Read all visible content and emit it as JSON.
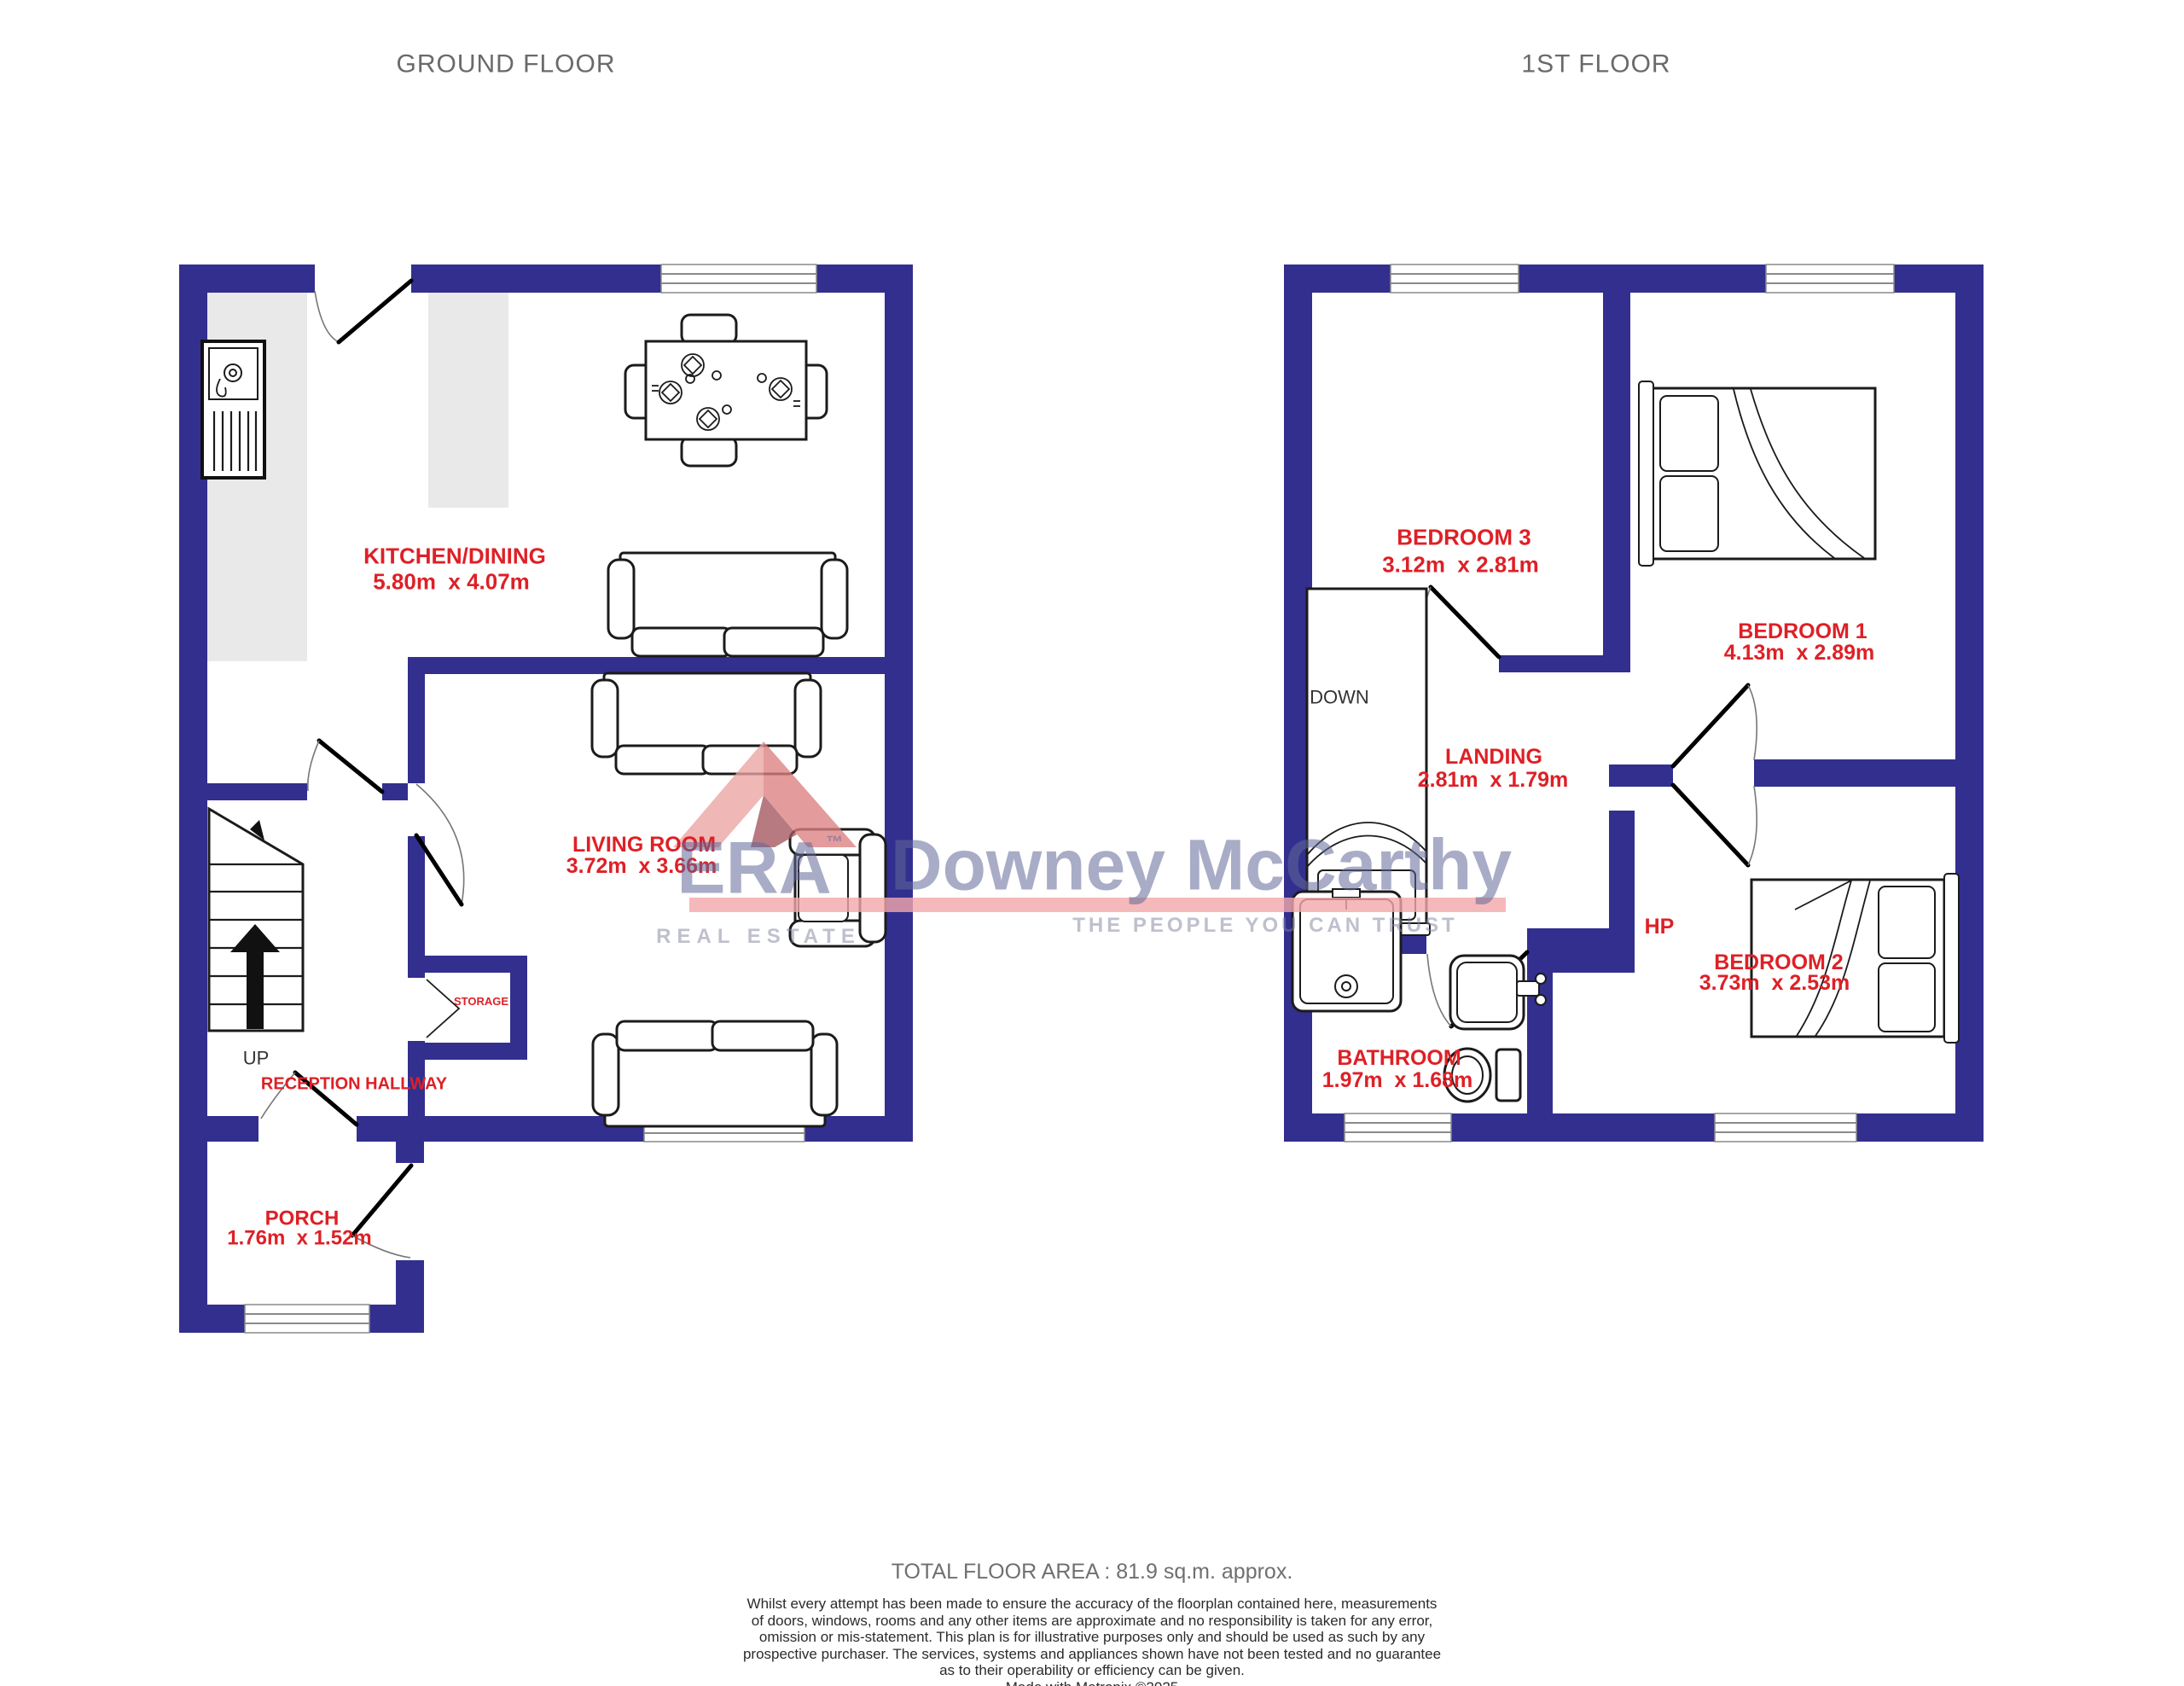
{
  "titles": {
    "ground": "GROUND FLOOR",
    "first": "1ST FLOOR"
  },
  "ground_floor": {
    "kitchen_dining": {
      "name": "KITCHEN/DINING",
      "dims": "5.80m  x 4.07m"
    },
    "living_room": {
      "name": "LIVING ROOM",
      "dims": "3.72m  x 3.66m"
    },
    "reception_hallway": {
      "name": "RECEPTION HALLWAY"
    },
    "storage": {
      "name": "STORAGE"
    },
    "porch": {
      "name": "PORCH",
      "dims": "1.76m  x 1.52m"
    },
    "stairs_label": "UP"
  },
  "first_floor": {
    "bedroom1": {
      "name": "BEDROOM 1",
      "dims": "4.13m  x 2.89m"
    },
    "bedroom2": {
      "name": "BEDROOM 2",
      "dims": "3.73m  x 2.53m"
    },
    "bedroom3": {
      "name": "BEDROOM 3",
      "dims": "3.12m  x 2.81m"
    },
    "landing": {
      "name": "LANDING",
      "dims": "2.81m  x 1.79m"
    },
    "bathroom": {
      "name": "BATHROOM",
      "dims": "1.97m  x 1.68m"
    },
    "hot_press": {
      "name": "HP"
    },
    "stairs_label": "DOWN"
  },
  "watermark": {
    "brand": "ERA",
    "tm": "™",
    "name": "Downey McCarthy",
    "tagline_left": "REAL ESTATE",
    "tagline_right": "THE PEOPLE YOU CAN TRUST"
  },
  "footer": {
    "total_area": "TOTAL FLOOR AREA : 81.9 sq.m. approx.",
    "disclaimer_lines": [
      "Whilst every attempt has been made to ensure the accuracy of the floorplan contained here, measurements",
      "of doors, windows, rooms and any other items are approximate and no responsibility is taken for any error,",
      "omission or mis-statement. This plan is for illustrative purposes only and should be used as such by any",
      "prospective purchaser. The services, systems and appliances shown have not been tested and no guarantee",
      "as to their operability or efficiency can be given."
    ],
    "credit": "Made with Metropix ©2025"
  },
  "colors": {
    "wall": "#322F8F",
    "label": "#DE2026",
    "counter": "#E9E9E9"
  }
}
